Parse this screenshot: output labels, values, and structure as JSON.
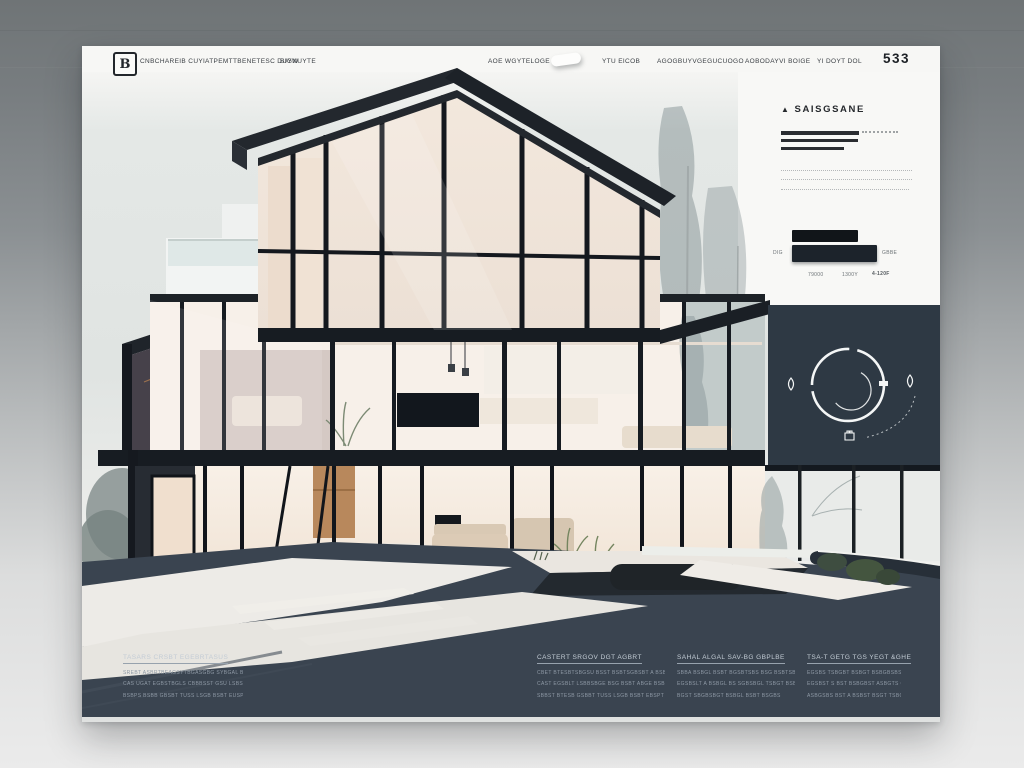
{
  "header": {
    "logo_glyph": "B",
    "nav_left": [
      {
        "label": "CNBCHAREIB CUYI"
      },
      {
        "label": "ATPEMTTBENETESC DUYW"
      },
      {
        "label": "BIGNUYTE"
      }
    ],
    "nav_right": [
      {
        "label": "AOE WGYTELOGE"
      },
      {
        "label": "YTU EICOB"
      },
      {
        "label": "AGOGBUYVGEGUCUOGO"
      },
      {
        "label": "AOBODAYVI BOIGE"
      },
      {
        "label": "YI DOYT DOL"
      }
    ],
    "menu_number": "533"
  },
  "info_panel": {
    "heading_icon": "▲",
    "heading": "SAISGSANE",
    "bar_label_left": "DIG",
    "bar_label_right": "GBBE",
    "bar_ticks": [
      "79000",
      "1300Y",
      "4-120F"
    ]
  },
  "footer": {
    "columns": [
      {
        "heading": "TASARS CRSBT EGEBRTASUS",
        "lines": [
          "SREBT ASBRTBEAGSYTBGASGBG SYBGAL BRBTBEBS",
          "CAS UGAT EGBSTBGLS CBBBSST GSU LSBSE BSSBTESLS",
          "BSBPS BSBB GBSBT TUSS LSGB BSBT EUSPS"
        ]
      },
      {
        "heading": "CASTERT SRGOV DGT AGBRT",
        "lines": [
          "CBET BTESBTSBGSU BSST BSBTSGBSBT A BSBTSBS BL",
          "CAST EGSBLT LSBBSBGE BSG BSBT ABGE BSBTSBS",
          "SBBST BTESB GSBBT TUSS LSGB BSBT EBSPT"
        ]
      },
      {
        "heading": "SAHAL ALGAL SAV-BG GBPLBE",
        "lines": [
          "SBBA BSBGL BSBT BGSBTSBS BSG BSBTSB BSL",
          "EGSBSLT A BSBGL BS SGBSBGL TSBGT BSBS BSG",
          "BGST SBGBSBGT BSBGL BSBT BSGBS"
        ]
      },
      {
        "heading": "TSA-T GETG TGS YEGT &GHE",
        "lines": [
          "EGSBS TSBGBT BSBGT BSBGBSBSS. T ABGSBSST EGS",
          "EGSBST S BST BSBGBST ASBGTS GSB BSBGBST",
          "ASBGSBS BST A BSBST BSGT TSBGST BSBGSBS"
        ]
      }
    ]
  },
  "colors": {
    "frame_dark": "#171c22",
    "panel_slate": "#2e3944",
    "footer_slate": "#3a4450",
    "interior_warm": "#f4ebe2",
    "wood": "#b8885c",
    "accent_white": "#f4f6f6"
  }
}
